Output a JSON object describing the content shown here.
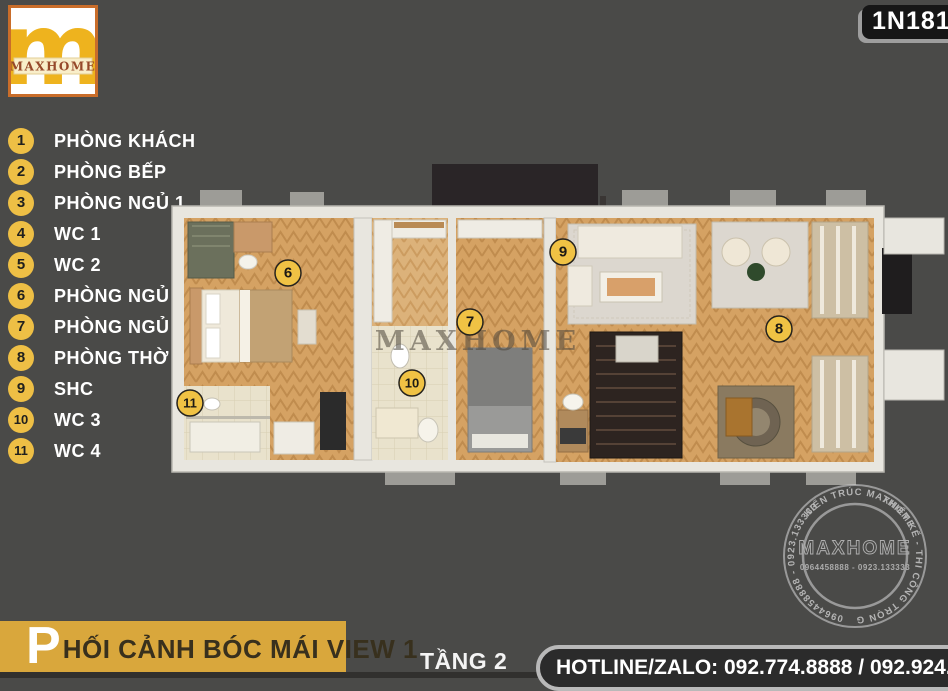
{
  "header": {
    "logo_text": "MAXHOME",
    "logo_monogram": "m",
    "code_badge": "1N1812"
  },
  "legend": {
    "items": [
      {
        "num": "1",
        "label": "PHÒNG KHÁCH"
      },
      {
        "num": "2",
        "label": "PHÒNG BẾP"
      },
      {
        "num": "3",
        "label": "PHÒNG NGỦ 1"
      },
      {
        "num": "4",
        "label": "WC 1"
      },
      {
        "num": "5",
        "label": "WC 2"
      },
      {
        "num": "6",
        "label": "PHÒNG NGỦ 2"
      },
      {
        "num": "7",
        "label": "PHÒNG NGỦ 3"
      },
      {
        "num": "8",
        "label": "PHÒNG THỜ"
      },
      {
        "num": "9",
        "label": "SHC"
      },
      {
        "num": "10",
        "label": "WC 3"
      },
      {
        "num": "11",
        "label": "WC 4"
      }
    ]
  },
  "plan": {
    "watermark": "MAXHOME",
    "markers": [
      "6",
      "7",
      "8",
      "9",
      "10",
      "11"
    ]
  },
  "stamp": {
    "arc_top": "KIẾN TRÚC MAXHOME",
    "arc_right": "THIẾT KẾ - THI CÔNG TRỌN GÓI",
    "arc_bottom": "0964458888 - 0923.133333",
    "center_brand": "MAXHOME",
    "center_phones": "0964458888 - 0923.133333"
  },
  "footer": {
    "title_initial": "P",
    "title_rest": "HỐI CẢNH BÓC MÁI VIEW 1",
    "floor_label": "TẦNG 2",
    "hotline": "HOTLINE/ZALO: 092.774.8888 / 092.924.5555"
  },
  "colors": {
    "background": "#4a4a48",
    "accent_gold": "#d9a73c",
    "marker_yellow": "#f0c244",
    "badge_bg": "#161616",
    "wood_floor": "#d5a263",
    "text_white": "#ffffff"
  }
}
